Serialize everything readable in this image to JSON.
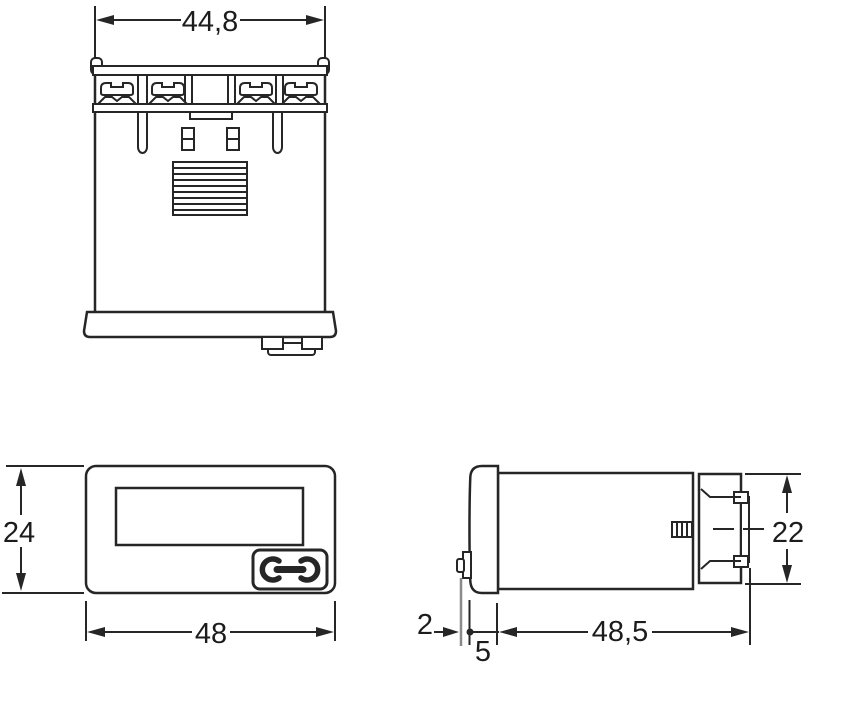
{
  "drawing": {
    "dimensions": {
      "rear_width_mm": "44,8",
      "front_height_mm": "24",
      "front_width_mm": "48",
      "rear_block_height_mm": "22",
      "key_protrusion_mm": "2",
      "bezel_depth_mm": "5",
      "case_depth_mm": "48,5"
    },
    "colors": {
      "line": "#262626",
      "background": "#ffffff",
      "gray_extension_line": "#8a8a8a"
    }
  }
}
